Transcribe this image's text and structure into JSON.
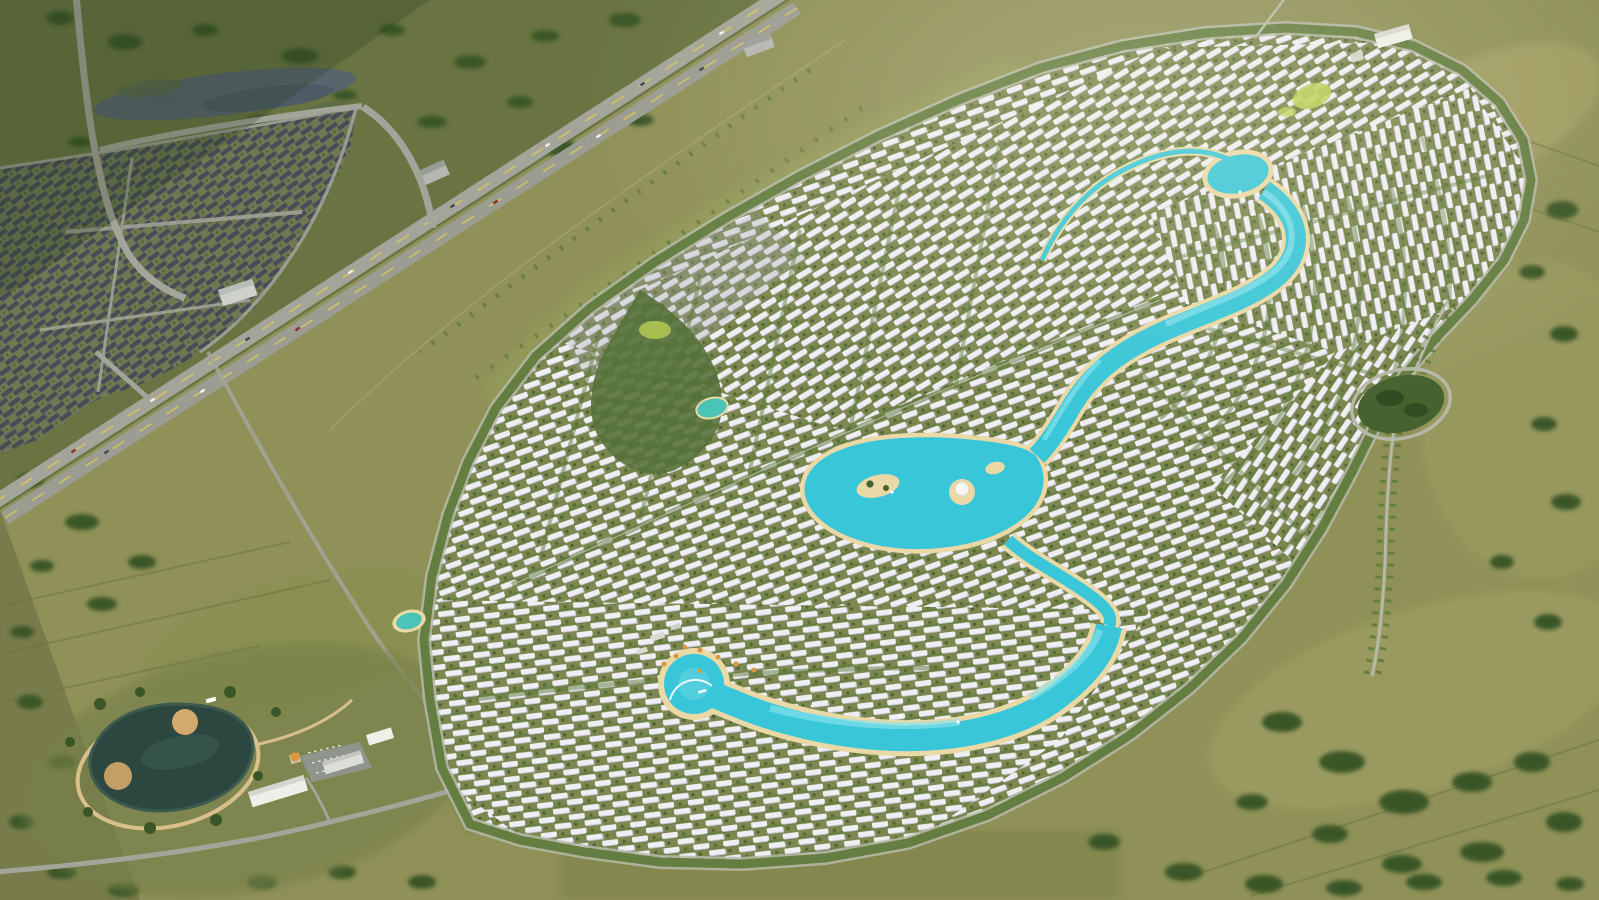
{
  "scene": {
    "type": "aerial-render",
    "description": "Aerial rendering of a large master-planned villa community with winding turquoise lagoons, dense rows of white villas, tree-lined perimeter roads and a landscaped roundabout, set in olive-green fields beside a diagonal highway. An older dark-roofed neighborhood, an elongated wetland pond and a dark landscaped park pond with white amenity buildings sit to the west and southwest.",
    "features": {
      "highway": "dual-carriageway highway crossing diagonally upper-left",
      "old_neighborhood": "existing dark-roofed suburb at top-left",
      "wetland": "elongated grey-blue wetland pond above the old suburb",
      "development": "oval master-planned community of white villa rows",
      "upper_lagoon": "turquoise lagoon ribbon winding from the north-east",
      "central_lagoon": "central lagoon with sandy islands and white dome pavilion",
      "lower_lagoon": "crescent beach lagoon with boardwalk and orange palms",
      "roundabout": "tree-filled oval roundabout on eastern avenue",
      "park_pond": "dark landscaped pond with tan walking loop at south-west",
      "clubhouse": "white flat-roof building at the northern edge"
    }
  },
  "palette": {
    "field_base": "#8f9158",
    "field_dark": "#64703f",
    "field_light": "#a5a468",
    "field_tan": "#b3ab6e",
    "tree_dark": "#3a5626",
    "tree_mid": "#46622f",
    "tree_deep": "#2c451d",
    "asphalt": "#a4a59a",
    "road_light": "#b6b9a8",
    "lane_yellow": "#d9c659",
    "old_roof": "#474c57",
    "old_ground": "#6f7753",
    "villa": "#efeef3",
    "villa_shadow": "#c6c3d4",
    "dev_ground": "#7d8750",
    "street_green": "#5d7a3a",
    "water": "#38c6d8",
    "water_deep": "#1d9cb8",
    "water_light": "#8ce4ee",
    "sand": "#ead9a6",
    "pond_dark": "#2b473f",
    "tan_path": "#d8c08a",
    "sand_dark": "#d3a96c",
    "accent_orange": "#dd973c",
    "lime": "#b9cf54",
    "building_white": "#efefe9",
    "building_gray": "#b4b6b0"
  }
}
